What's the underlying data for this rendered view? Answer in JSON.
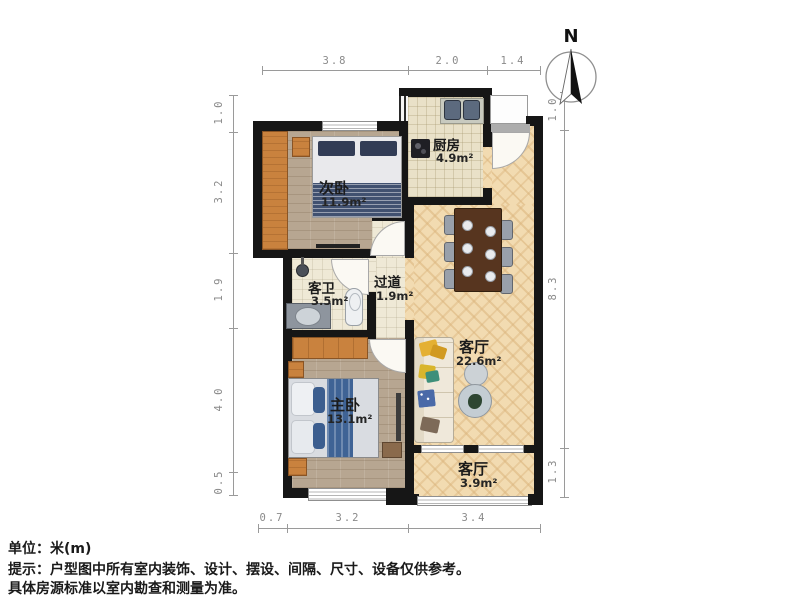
{
  "rooms": [
    {
      "id": "kitchen",
      "name": "厨房",
      "area": "4.9m²"
    },
    {
      "id": "secondary-bedroom",
      "name": "次卧",
      "area": "11.9m²"
    },
    {
      "id": "guest-bathroom",
      "name": "客卫",
      "area": "3.5m²"
    },
    {
      "id": "hallway",
      "name": "过道",
      "area": "1.9m²"
    },
    {
      "id": "living-room",
      "name": "客厅",
      "area": "22.6m²"
    },
    {
      "id": "master-bedroom",
      "name": "主卧",
      "area": "13.1m²"
    },
    {
      "id": "balcony",
      "name": "客厅",
      "area": "3.9m²"
    }
  ],
  "dims": {
    "top": [
      "3.8",
      "2.0",
      "1.4"
    ],
    "left": [
      "1.0",
      "3.2",
      "1.9",
      "4.0",
      "0.5"
    ],
    "right": [
      "1.0",
      "8.3",
      "1.3"
    ],
    "bottom": [
      "0.7",
      "3.2",
      "3.4"
    ]
  },
  "compass": {
    "north_label": "N"
  },
  "footer": {
    "unit": "单位：米(m)",
    "tip": "提示：户型图中所有室内装饰、设计、摆设、间隔、尺寸、设备仅供参考。",
    "tip2": "具体房源标准以室内勘查和测量为准。"
  },
  "colors": {
    "wall": "#161616",
    "wood_light": "#f2dbb1",
    "wood_dark": "#b7a691",
    "tile": "#e9e1c8",
    "wardrobe_orange": "#c9823e",
    "bed_navy": "#415170",
    "bed_blue": "#3f6395",
    "sofa_yellow": "#e4b033",
    "sofa_blue": "#4a6aa8",
    "table_brown": "#57351f",
    "dim_gray": "#8a8a8a"
  }
}
